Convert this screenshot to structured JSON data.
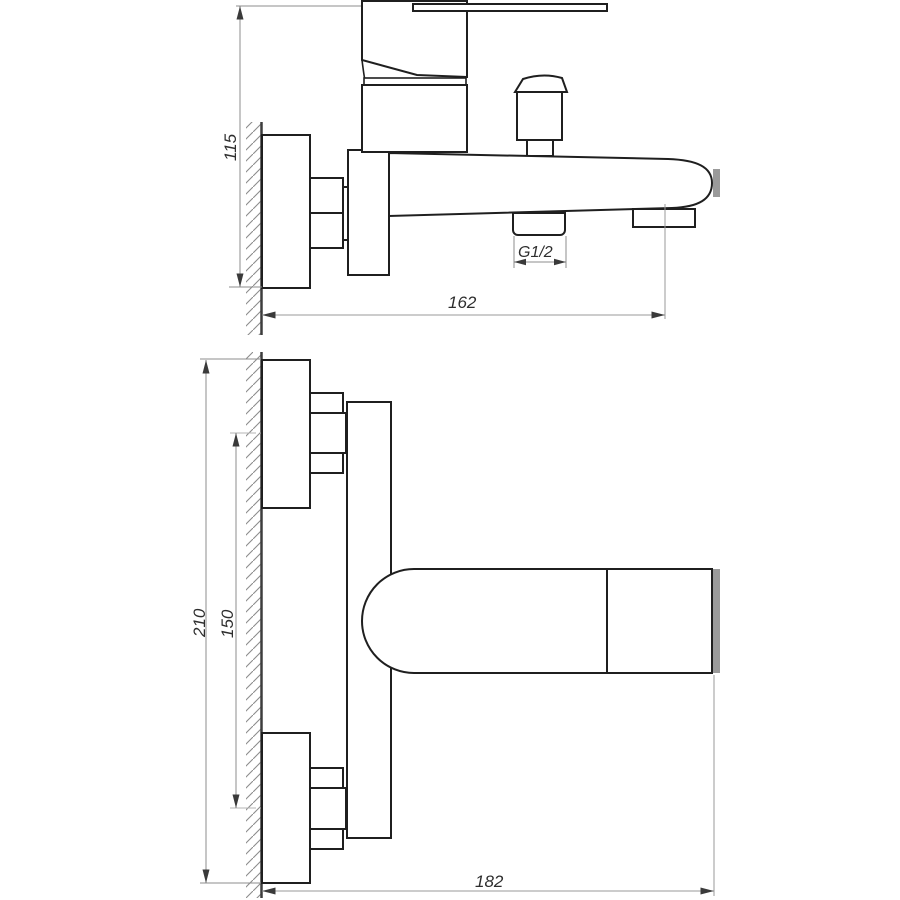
{
  "drawing": {
    "dimensions": {
      "side_height": "115",
      "side_reach": "162",
      "thread": "G1/2",
      "plan_height": "210",
      "plan_centers": "150",
      "plan_length": "182"
    },
    "colors": {
      "background": "#ffffff",
      "outline": "#1f1f1f",
      "wall_line": "#3d3d3d",
      "hatch": "#8c8c8c",
      "dimension_line": "#8c8c8c",
      "centerline": "#b4b4b4",
      "arrow": "#3a3a3a",
      "label_text": "#2e2e2e",
      "spout_tip_gray": "#9a9a9a"
    }
  }
}
